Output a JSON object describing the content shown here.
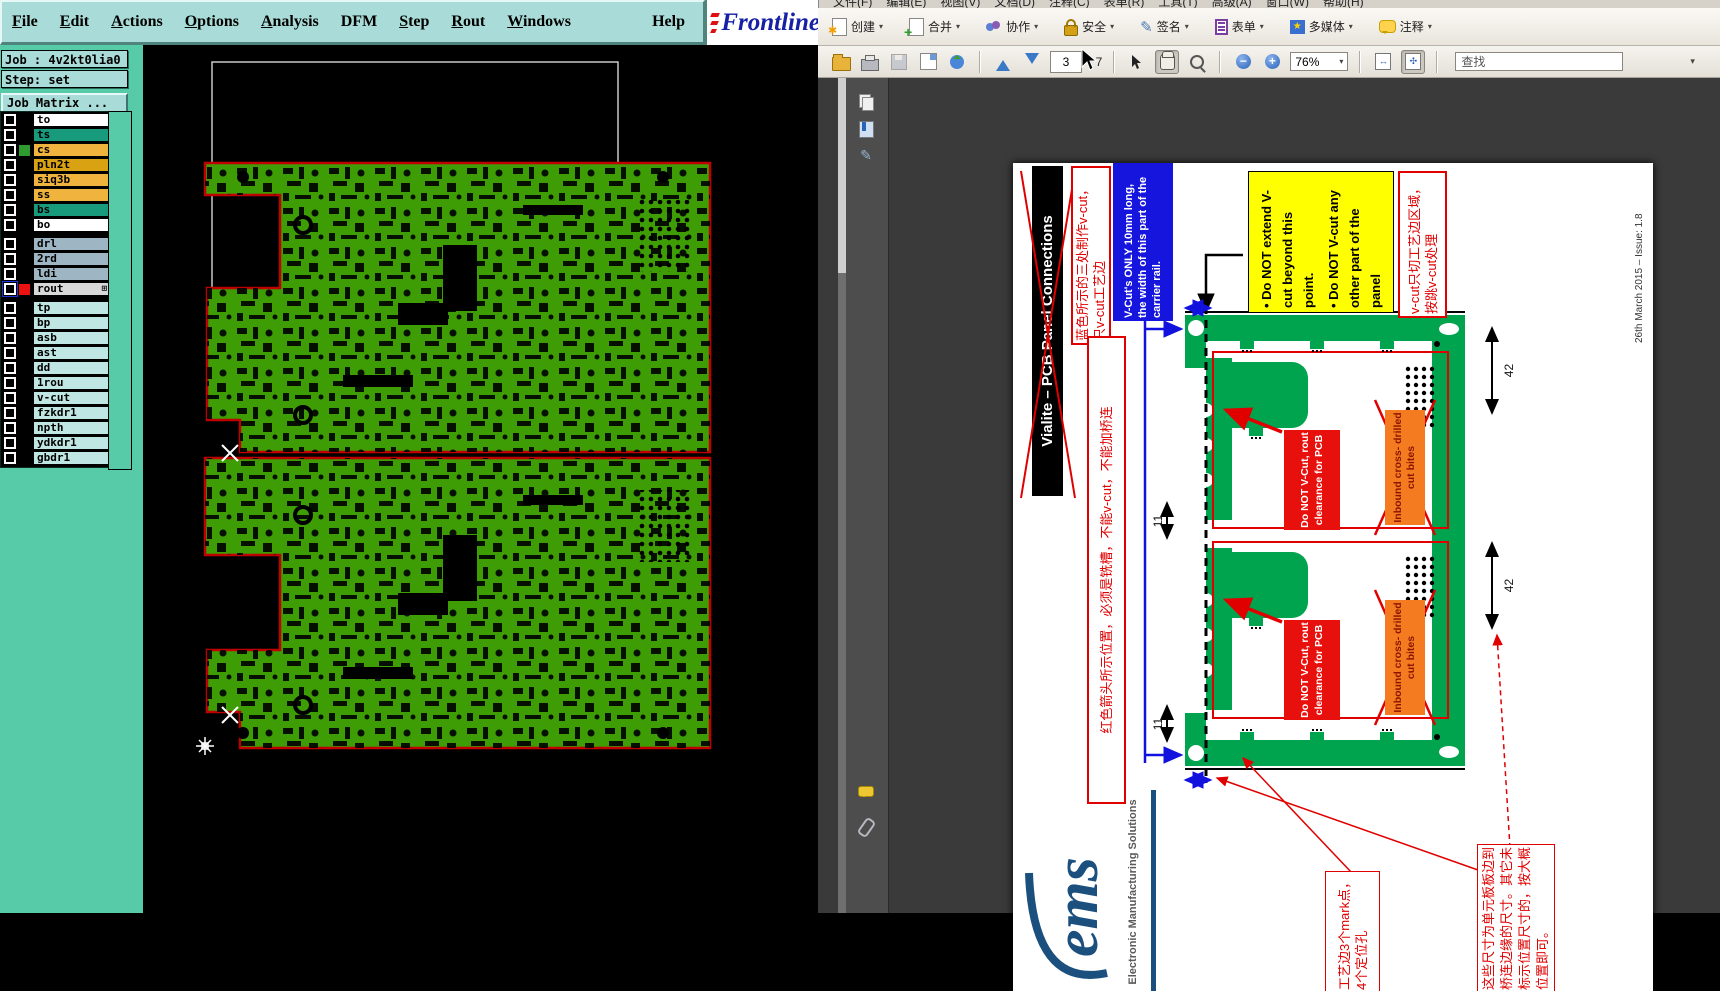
{
  "left_app": {
    "menu": {
      "items": [
        "File",
        "Edit",
        "Actions",
        "Options",
        "Analysis",
        "DFM",
        "Step",
        "Rout",
        "Windows"
      ],
      "help": "Help"
    },
    "logo_text": "Frontline",
    "job": {
      "job_label": "Job : 4v2kt0lia0",
      "step_label": "Step: set",
      "matrix_button": "Job Matrix ..."
    },
    "grid_icon": "⊞",
    "layer_groups": [
      {
        "rows": [
          {
            "name": "to",
            "color": "#ffffff"
          },
          {
            "name": "ts",
            "color": "#189b7d"
          },
          {
            "name": "cs",
            "color": "#efb33e",
            "swatch": "#2f9a2f"
          },
          {
            "name": "pln2t",
            "color": "#d9a213"
          },
          {
            "name": "siq3b",
            "color": "#efb33e"
          },
          {
            "name": "ss",
            "color": "#efb33e"
          },
          {
            "name": "bs",
            "color": "#189b7d"
          },
          {
            "name": "bo",
            "color": "#ffffff"
          }
        ]
      },
      {
        "rows": [
          {
            "name": "drl",
            "color": "#9eb5c4"
          },
          {
            "name": "2rd",
            "color": "#9eb5c4"
          },
          {
            "name": "ldi",
            "color": "#9eb5c4"
          },
          {
            "name": "rout",
            "color": "#d8d8d8",
            "swatch": "#ee1111"
          }
        ]
      },
      {
        "rows": [
          {
            "name": "tp",
            "color": "#bfe6e2"
          },
          {
            "name": "bp",
            "color": "#bfe6e2"
          },
          {
            "name": "asb",
            "color": "#bfe6e2"
          },
          {
            "name": "ast",
            "color": "#bfe6e2"
          },
          {
            "name": "dd",
            "color": "#bfe6e2"
          },
          {
            "name": "1rou",
            "color": "#bfe6e2"
          },
          {
            "name": "v-cut",
            "color": "#bfe6e2"
          },
          {
            "name": "fzkdr1",
            "color": "#bfe6e2"
          },
          {
            "name": "npth",
            "color": "#bfe6e2"
          },
          {
            "name": "ydkdr1",
            "color": "#bfe6e2"
          },
          {
            "name": "gbdr1",
            "color": "#bfe6e2"
          }
        ]
      }
    ]
  },
  "right_app": {
    "menu_items": [
      "文件(F)",
      "编辑(E)",
      "视图(V)",
      "文档(D)",
      "注释(C)",
      "表单(R)",
      "工具(T)",
      "高级(A)",
      "窗口(W)",
      "帮助(H)"
    ],
    "toolbar_buttons": [
      {
        "label": "创建"
      },
      {
        "label": "合并"
      },
      {
        "label": "协作"
      },
      {
        "label": "安全"
      },
      {
        "label": "签名"
      },
      {
        "label": "表单"
      },
      {
        "label": "多媒体"
      },
      {
        "label": "注释"
      }
    ],
    "nav": {
      "page_current": "3",
      "page_total": "/ 7",
      "zoom_level": "76%",
      "find_label": "查找"
    },
    "icons": {
      "dropdown": "▾",
      "star": "✱",
      "plus": "+",
      "minus": "−",
      "media_star": "★",
      "pen": "✎",
      "fit_width": "↔",
      "fit_page": "✣"
    },
    "pdf": {
      "title_banner": "Vialite – PCB Panel Connections",
      "note_blue_cn": "蓝色所示的三处制作v-cut，只v-cut工艺边",
      "note_vcut_en": "V-Cut's ONLY 10mm long, the width of this part of the carrier rail.",
      "yellow_bullet1": "• Do NOT extend V-cut beyond this point.",
      "yellow_bullet2": "• Do NOT V-cut any other part of the panel",
      "note_vcut_cn": "v-cut只切工艺边区域，按跳v-cut处理",
      "issue_date": "26th March 2015 – Issue: 1.8",
      "note_red_tall": "红色箭头所示位置，必须是铣槽，不能v-cut，不能加桥连",
      "do_not_vcut": "Do NOT V-Cut, rout clearance for PCB",
      "inbound_bites": "Inbound cross- drilled cut bites",
      "dim_42": "42",
      "dim_11": "11",
      "ems_logo": "ems",
      "ems_caption": "Electronic Manufacturing Solutions",
      "note_marks": "工艺边3个mark点，4个定位孔",
      "note_dims": "这些尺寸为单元板板边到桥连边缘的尺寸。其它未标示位置尺寸的，按大概位置即可。"
    }
  }
}
